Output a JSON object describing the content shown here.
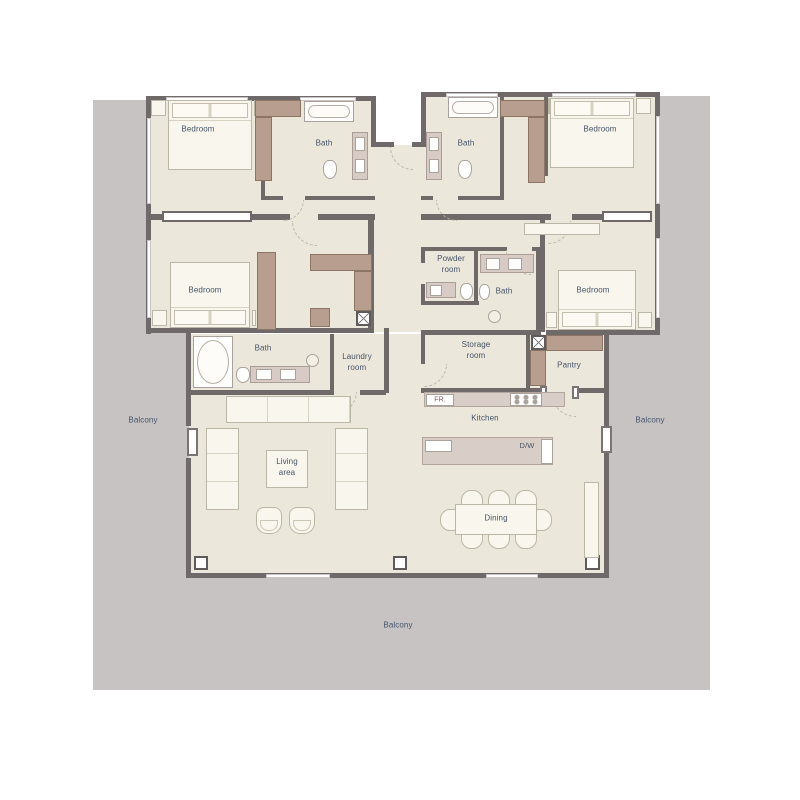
{
  "plan": {
    "type": "floor-plan",
    "labels": {
      "bedroom_top_left": "Bedroom",
      "bath_top_left": "Bath",
      "bath_top_right": "Bath",
      "bedroom_top_right": "Bedroom",
      "bedroom_mid_left": "Bedroom",
      "powder_room": "Powder\nroom",
      "bath_mid_right": "Bath",
      "bedroom_mid_right": "Bedroom",
      "bath_master": "Bath",
      "laundry_room": "Laundry\nroom",
      "storage_room": "Storage\nroom",
      "pantry": "Pantry",
      "fridge": "FR.",
      "kitchen": "Kitchen",
      "dishwasher": "D/W",
      "living_area": "Living\narea",
      "dining": "Dining",
      "balcony_left": "Balcony",
      "balcony_right": "Balcony",
      "balcony_bottom": "Balcony"
    },
    "colors": {
      "floor": "#ece7db",
      "balcony": "#c7c3c3",
      "wall": "#6f696a",
      "wardrobe": "#b89e8e",
      "counter": "#d9cec7",
      "furniture": "#f9f6ed",
      "label_text": "#44546a",
      "fridge_text": "#8a5c5c"
    },
    "icons": {
      "xbox": "service-shaft",
      "arc": "door-swing",
      "drain": "shower-drain"
    }
  }
}
